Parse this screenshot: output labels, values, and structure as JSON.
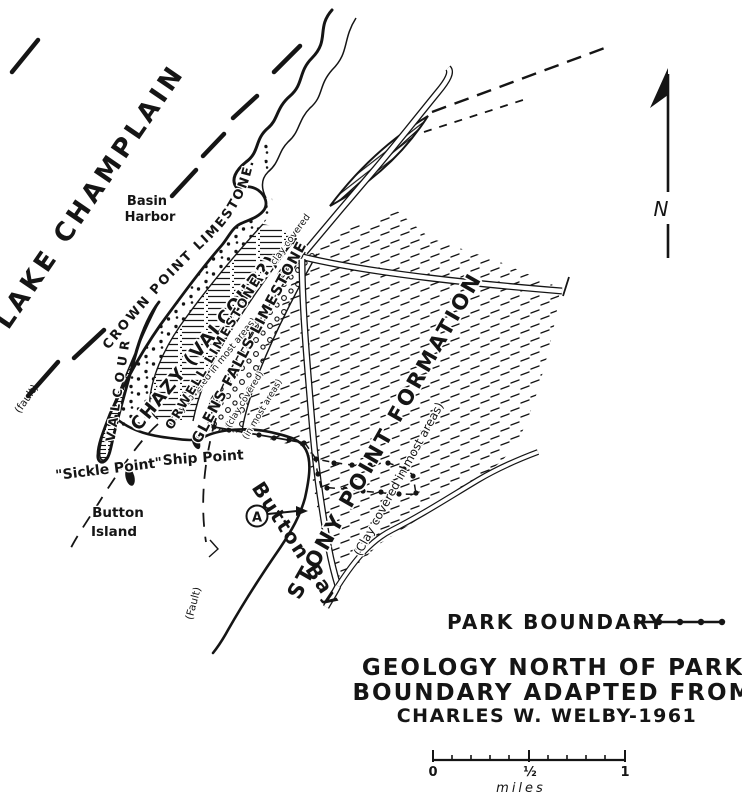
{
  "map": {
    "lake_label": "LAKE CHAMPLAIN",
    "north_label": "N",
    "places": {
      "basin_harbor_line1": "Basin",
      "basin_harbor_line2": "Harbor",
      "ship_point": "Ship Point",
      "sickle_point": "\"Sickle Point\"",
      "button_island_line1": "Button",
      "button_island_line2": "Island",
      "button_bay": "Button  Bay",
      "point_a": "A"
    },
    "faults": {
      "upper": "(fault)",
      "lower": "(Fault)"
    },
    "units": {
      "crown_point": "CROWN POINT LIMESTONE.",
      "valcour": "VALCOUR",
      "chazy": "CHAZY (VALCOUR?)",
      "chazy_note": "(clay covered in most areas)",
      "orwell": "ORWELL  LIMESTONE",
      "glens_falls": "GLENS FALLS LIMESTONE",
      "glens_note1": "(clay covered)",
      "glens_note2": "(in most areas)",
      "stony_point": "STONY POINT FORMATION",
      "stony_note": "(Clay covered in most areas)",
      "clay_covered_road": "clay covered"
    },
    "legend": {
      "park_boundary": "PARK BOUNDARY"
    },
    "title": [
      "GEOLOGY NORTH OF PARK",
      "BOUNDARY ADAPTED FROM",
      "CHARLES  W.  WELBY-1961"
    ],
    "scale": {
      "zero": "0",
      "half": "½",
      "one": "1",
      "unit": "miles"
    },
    "colors": {
      "ink": "#151515",
      "paper": "#ffffff"
    }
  }
}
